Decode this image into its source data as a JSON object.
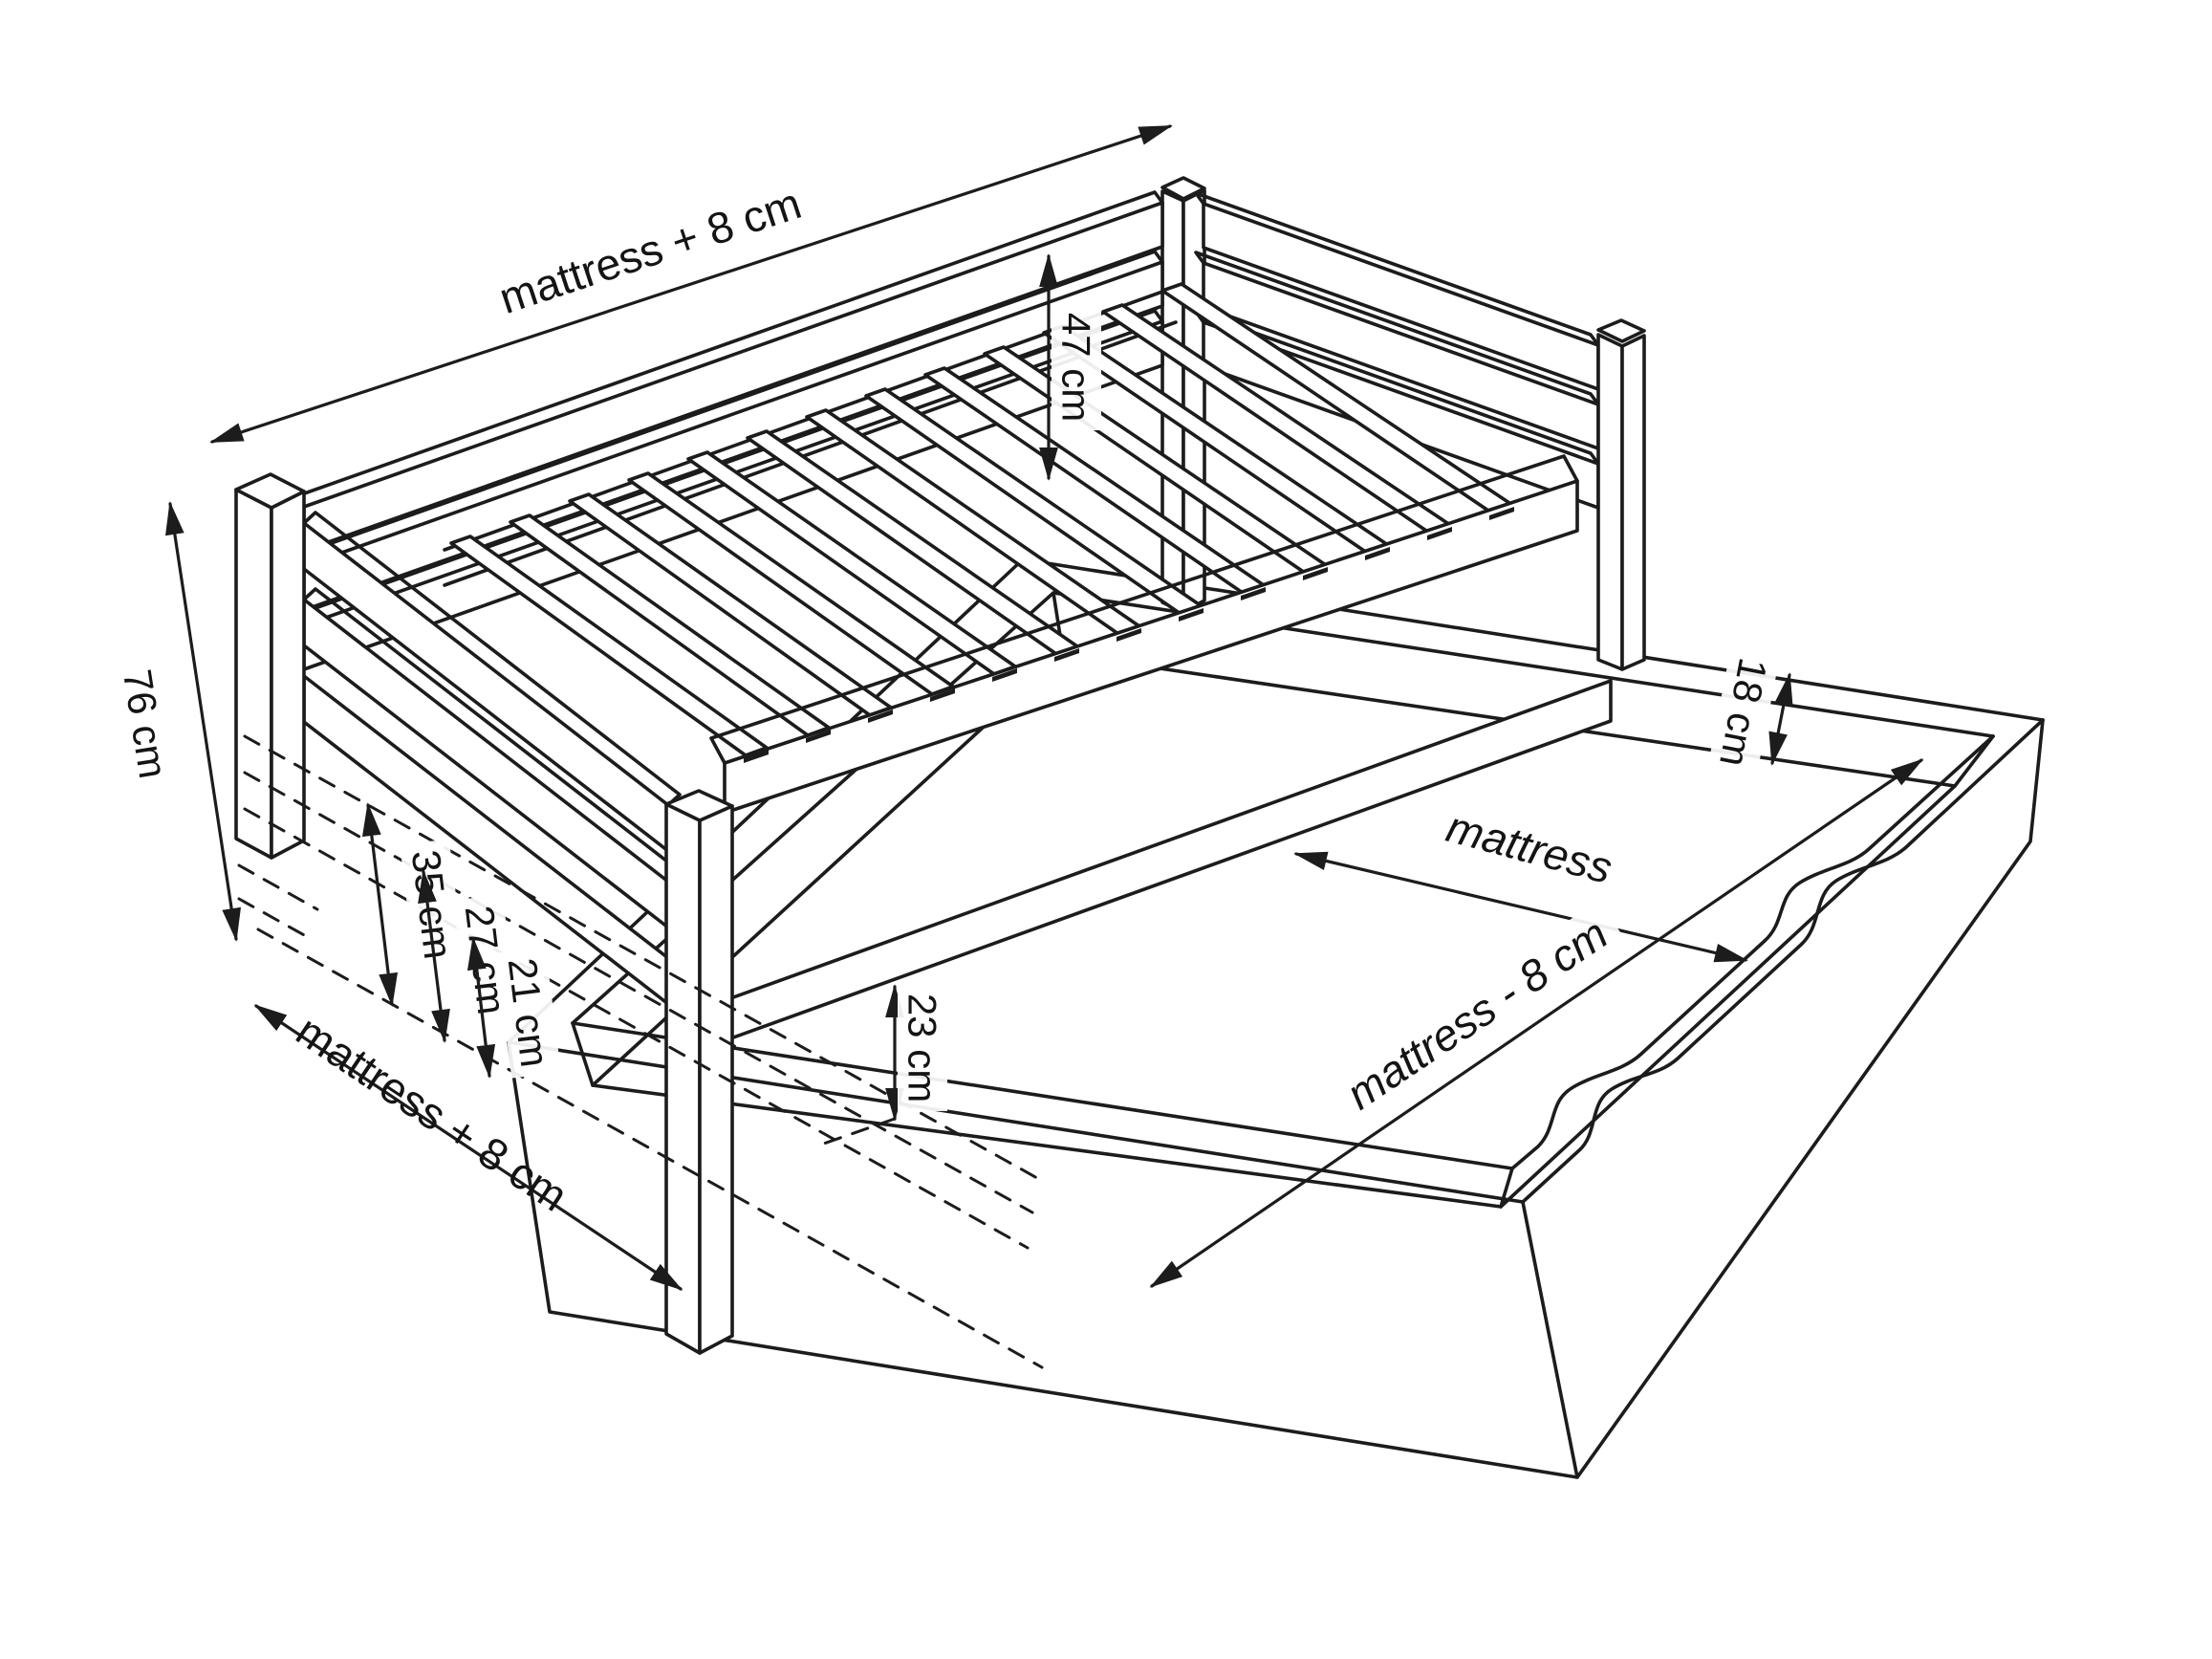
{
  "figure": {
    "type": "technical-dimension-drawing",
    "subject": "single bed with guard rails and pull-out trundle drawer",
    "background_color": "#ffffff",
    "line_color": "#1c1c1c",
    "labels": {
      "bed_length_top": "mattress + 8 cm",
      "guard_height": "47 cm",
      "bed_height": "76 cm",
      "bed_width_foot": "mattress + 8 cm",
      "level_35": "35 cm",
      "level_27": "27 cm",
      "level_21": "21 cm",
      "under_bed_clearance": "23 cm",
      "drawer_inner_depth": "18 cm",
      "drawer_inner_width": "mattress",
      "drawer_inner_length": "mattress - 8 cm"
    }
  }
}
